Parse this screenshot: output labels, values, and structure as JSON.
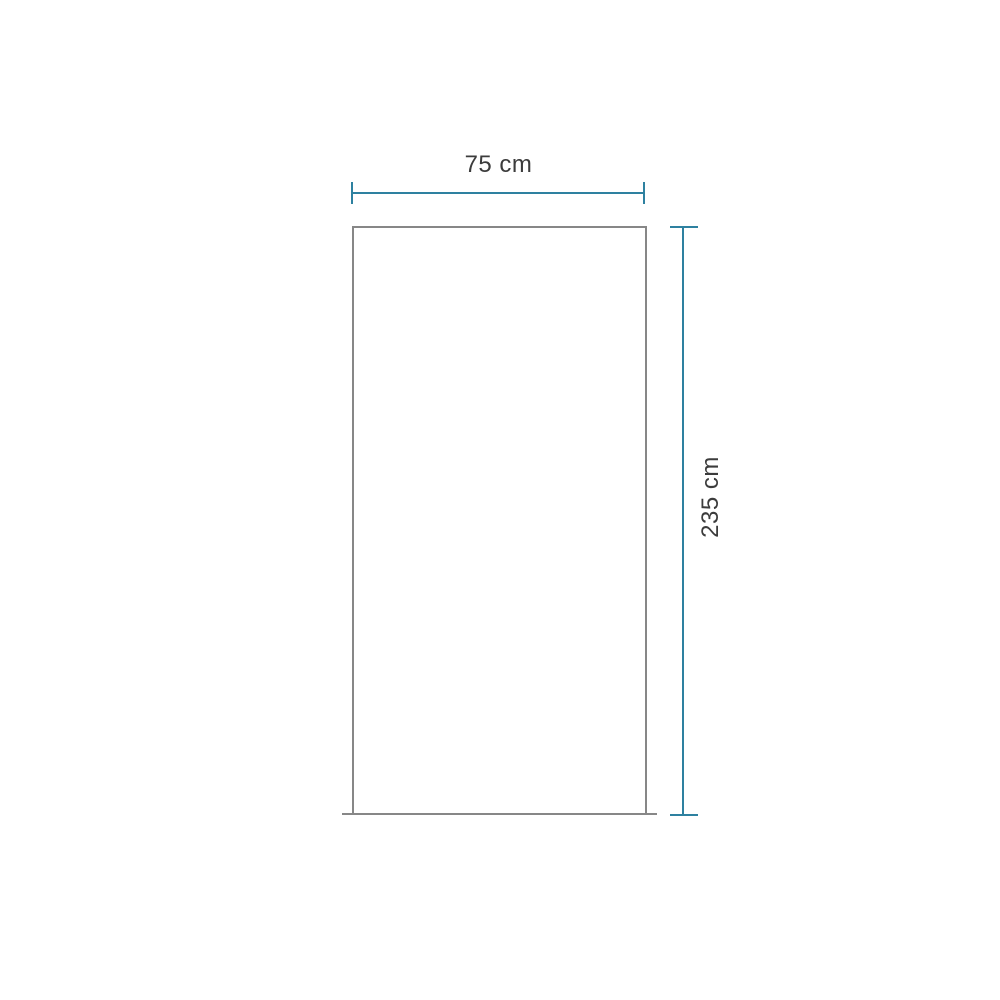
{
  "diagram": {
    "title": "panel-dimension-drawing",
    "width_label": "75 cm",
    "height_label": "235 cm"
  },
  "colors": {
    "dimension-color": "#2e81a0",
    "shape-border-color": "#878787",
    "label-color": "#3c3c3c",
    "background-color": "#ffffff"
  }
}
